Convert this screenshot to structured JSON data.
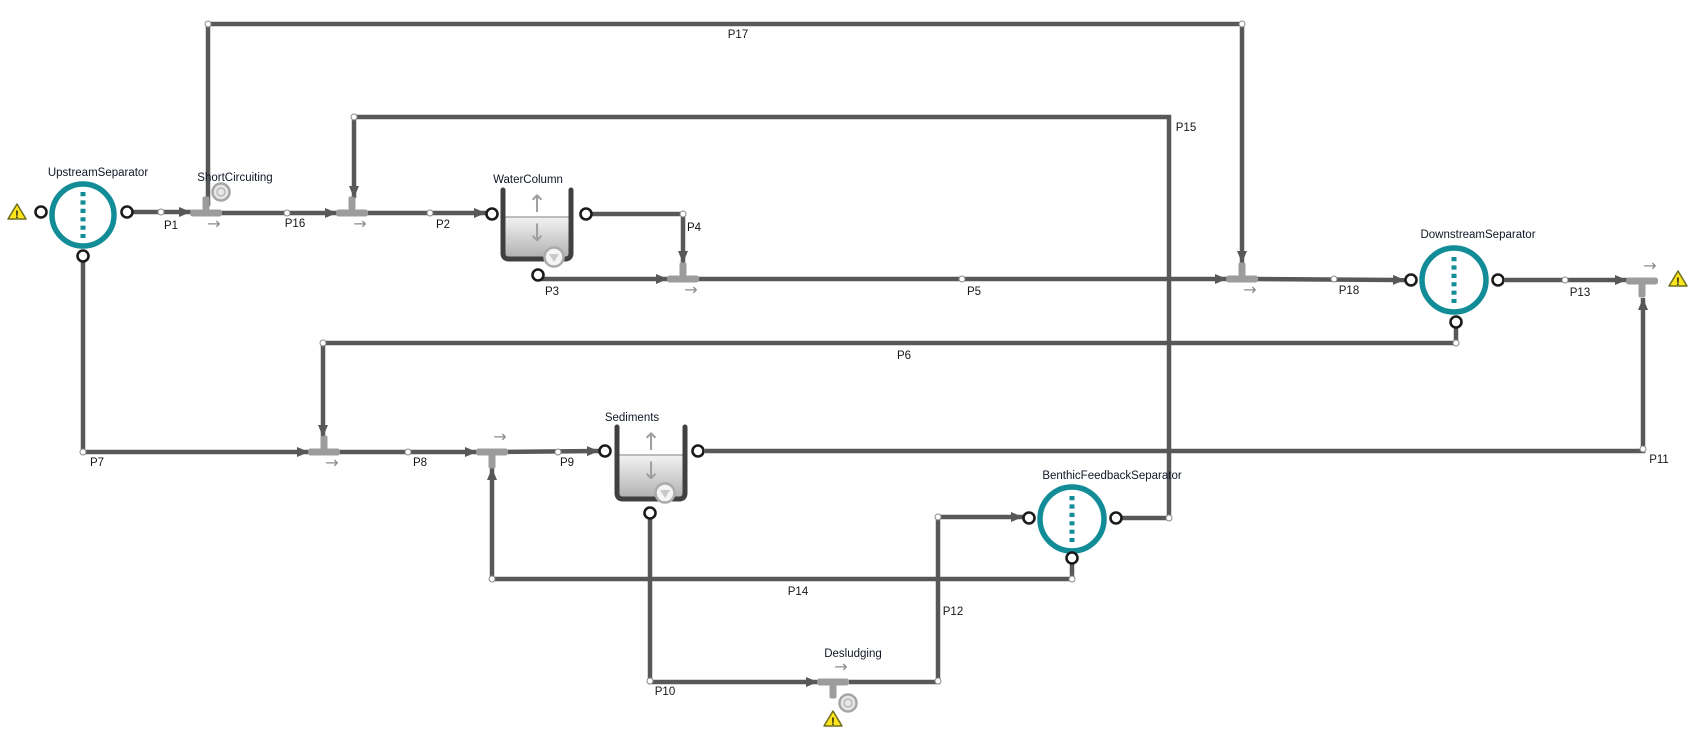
{
  "canvas": {
    "width": 1700,
    "height": 729,
    "background": "#ffffff"
  },
  "colors": {
    "pipe": "#585858",
    "tee": "#9c9c9c",
    "direction_arrow": "#8c8c8c",
    "separator_teal": "#128d98",
    "tank_wall": "#404040",
    "tank_fill_top": "#f3f3f3",
    "tank_fill_bottom": "#b2b2b2",
    "water_line": "#a8a8a8",
    "tank_arrow": "#9e9e9e",
    "port_ring": "#1b1b1b",
    "dot_ring": "#8a8a8a",
    "element_label": "#101826",
    "pipe_label": "#161616",
    "warning_fill": "#ffe51c",
    "warning_border": "#6e6e1e",
    "icon_ring": "#a5a5a5",
    "icon_fill": "#e3e3e3"
  },
  "separators": [
    {
      "id": "upstream-separator",
      "label": "UpstreamSeparator",
      "cx": 83,
      "cy": 215,
      "r": 31,
      "label_cx": 98,
      "label_cy": 172,
      "ports": [
        {
          "x": 41,
          "y": 212
        },
        {
          "x": 127,
          "y": 212
        },
        {
          "x": 83,
          "y": 256
        }
      ]
    },
    {
      "id": "downstream-separator",
      "label": "DownstreamSeparator",
      "cx": 1454,
      "cy": 280,
      "r": 32,
      "label_cx": 1478,
      "label_cy": 234,
      "ports": [
        {
          "x": 1411,
          "y": 280
        },
        {
          "x": 1498,
          "y": 280
        },
        {
          "x": 1456,
          "y": 322
        }
      ]
    },
    {
      "id": "benthic-feedback-separator",
      "label": "BenthicFeedbackSeparator",
      "cx": 1072,
      "cy": 519,
      "r": 32,
      "label_cx": 1112,
      "label_cy": 475,
      "ports": [
        {
          "x": 1029,
          "y": 518
        },
        {
          "x": 1116,
          "y": 518
        },
        {
          "x": 1072,
          "y": 558
        }
      ]
    }
  ],
  "tanks": [
    {
      "id": "water-column",
      "label": "WaterColumn",
      "x1": 503,
      "x2": 571,
      "top": 190,
      "bottom": 259,
      "water_y": 217,
      "label_cx": 528,
      "label_cy": 179,
      "ports": [
        {
          "x": 492,
          "y": 214
        },
        {
          "x": 586,
          "y": 214
        },
        {
          "x": 538,
          "y": 275
        }
      ],
      "icon": {
        "x": 554,
        "y": 257
      }
    },
    {
      "id": "sediments",
      "label": "Sediments",
      "x1": 617,
      "x2": 685,
      "top": 427,
      "bottom": 499,
      "water_y": 455,
      "label_cx": 632,
      "label_cy": 417,
      "ports": [
        {
          "x": 605,
          "y": 451
        },
        {
          "x": 698,
          "y": 451
        },
        {
          "x": 650,
          "y": 513
        }
      ],
      "icon": {
        "x": 665,
        "y": 493
      }
    }
  ],
  "junctions": [
    {
      "id": "short-circuiting",
      "label": "ShortCircuiting",
      "x": 206,
      "y": 213,
      "stub": "up",
      "arrow": "below",
      "icon": {
        "x": 221,
        "y": 192
      },
      "label_cx": 235,
      "label_cy": 177
    },
    {
      "id": "junction-p16-p2",
      "x": 352,
      "y": 213,
      "stub": "up",
      "arrow": "below"
    },
    {
      "id": "junction-p3-p5",
      "x": 683,
      "y": 279,
      "stub": "up",
      "arrow": "below"
    },
    {
      "id": "junction-p5-p18",
      "x": 1242,
      "y": 279,
      "stub": "up",
      "arrow": "below"
    },
    {
      "id": "junction-p13-outlet",
      "x": 1642,
      "y": 281,
      "stub": "down",
      "arrow": "above"
    },
    {
      "id": "junction-p7-p8",
      "x": 324,
      "y": 452,
      "stub": "up",
      "arrow": "below"
    },
    {
      "id": "junction-p8-p9",
      "x": 492,
      "y": 452,
      "stub": "down",
      "arrow": "above"
    },
    {
      "id": "desludging",
      "label": "Desludging",
      "x": 833,
      "y": 682,
      "stub": "down",
      "arrow": "above",
      "icon": {
        "x": 848,
        "y": 703
      },
      "label_cx": 853,
      "label_cy": 653
    }
  ],
  "warnings": [
    {
      "id": "warning-upstream-separator",
      "x": 17,
      "y": 212
    },
    {
      "id": "warning-outlet",
      "x": 1678,
      "y": 279
    },
    {
      "id": "warning-desludging",
      "x": 833,
      "y": 719
    }
  ],
  "pipes": [
    {
      "id": "P1",
      "label": "P1",
      "points": [
        [
          133,
          212
        ],
        [
          191,
          212
        ]
      ],
      "label_cx": 171,
      "label_cy": 225,
      "dots": [
        [
          161,
          212
        ]
      ]
    },
    {
      "id": "P16",
      "label": "P16",
      "points": [
        [
          215,
          213
        ],
        [
          337,
          213
        ]
      ],
      "label_cx": 295,
      "label_cy": 223,
      "dots": [
        [
          287,
          213
        ]
      ]
    },
    {
      "id": "P2",
      "label": "P2",
      "points": [
        [
          359,
          213
        ],
        [
          486,
          213
        ]
      ],
      "label_cx": 443,
      "label_cy": 224,
      "dots": [
        [
          430,
          213
        ]
      ]
    },
    {
      "id": "P17",
      "label": "P17",
      "points": [
        [
          208,
          206
        ],
        [
          208,
          24
        ],
        [
          1242,
          24
        ],
        [
          1242,
          263
        ]
      ],
      "label_cx": 738,
      "label_cy": 34,
      "dots": [
        [
          208,
          24
        ],
        [
          1242,
          24
        ]
      ]
    },
    {
      "id": "P15",
      "label": "P15",
      "points": [
        [
          1122,
          518
        ],
        [
          1169,
          518
        ],
        [
          1169,
          117
        ],
        [
          354,
          117
        ],
        [
          354,
          198
        ]
      ],
      "label_cx": 1186,
      "label_cy": 127,
      "dots": [
        [
          1169,
          518
        ],
        [
          354,
          117
        ]
      ]
    },
    {
      "id": "P4",
      "label": "P4",
      "points": [
        [
          592,
          214
        ],
        [
          683,
          214
        ],
        [
          683,
          263
        ]
      ],
      "label_cx": 694,
      "label_cy": 227,
      "dots": [
        [
          683,
          214
        ]
      ]
    },
    {
      "id": "P3",
      "label": "P3",
      "points": [
        [
          538,
          277
        ],
        [
          538,
          279
        ],
        [
          668,
          279
        ]
      ],
      "label_cx": 552,
      "label_cy": 291,
      "dots": []
    },
    {
      "id": "P5",
      "label": "P5",
      "points": [
        [
          691,
          279
        ],
        [
          1227,
          279
        ]
      ],
      "label_cx": 974,
      "label_cy": 291,
      "dots": [
        [
          962,
          279
        ]
      ]
    },
    {
      "id": "P18",
      "label": "P18",
      "points": [
        [
          1251,
          279
        ],
        [
          1405,
          280
        ]
      ],
      "label_cx": 1349,
      "label_cy": 290,
      "dots": [
        [
          1334,
          279
        ]
      ]
    },
    {
      "id": "P13",
      "label": "P13",
      "points": [
        [
          1505,
          280
        ],
        [
          1627,
          280
        ]
      ],
      "label_cx": 1580,
      "label_cy": 292,
      "dots": [
        [
          1565,
          280
        ]
      ]
    },
    {
      "id": "P11",
      "label": "P11",
      "points": [
        [
          705,
          451
        ],
        [
          1643,
          451
        ],
        [
          1643,
          298
        ]
      ],
      "label_cx": 1659,
      "label_cy": 459,
      "dots": [
        [
          1643,
          449
        ]
      ]
    },
    {
      "id": "P6",
      "label": "P6",
      "points": [
        [
          1456,
          328
        ],
        [
          1456,
          343
        ],
        [
          323,
          343
        ],
        [
          323,
          437
        ]
      ],
      "label_cx": 904,
      "label_cy": 355,
      "dots": [
        [
          1456,
          343
        ],
        [
          323,
          343
        ]
      ]
    },
    {
      "id": "P7",
      "label": "P7",
      "points": [
        [
          83,
          262
        ],
        [
          83,
          452
        ],
        [
          309,
          452
        ]
      ],
      "label_cx": 97,
      "label_cy": 462,
      "dots": [
        [
          83,
          452
        ]
      ]
    },
    {
      "id": "P8",
      "label": "P8",
      "points": [
        [
          333,
          452
        ],
        [
          477,
          452
        ]
      ],
      "label_cx": 420,
      "label_cy": 462,
      "dots": [
        [
          408,
          452
        ]
      ]
    },
    {
      "id": "P9",
      "label": "P9",
      "points": [
        [
          501,
          452
        ],
        [
          599,
          451
        ]
      ],
      "label_cx": 567,
      "label_cy": 462,
      "dots": [
        [
          558,
          452
        ]
      ]
    },
    {
      "id": "P14",
      "label": "P14",
      "points": [
        [
          1072,
          564
        ],
        [
          1072,
          579
        ],
        [
          492,
          579
        ],
        [
          492,
          468
        ]
      ],
      "label_cx": 798,
      "label_cy": 591,
      "dots": [
        [
          1072,
          579
        ],
        [
          492,
          579
        ]
      ]
    },
    {
      "id": "P10",
      "label": "P10",
      "points": [
        [
          650,
          519
        ],
        [
          650,
          682
        ],
        [
          818,
          682
        ]
      ],
      "label_cx": 665,
      "label_cy": 691,
      "dots": [
        [
          650,
          681
        ]
      ]
    },
    {
      "id": "P12",
      "label": "P12",
      "points": [
        [
          849,
          682
        ],
        [
          938,
          682
        ],
        [
          938,
          517
        ],
        [
          1023,
          517
        ]
      ],
      "label_cx": 953,
      "label_cy": 611,
      "dots": [
        [
          938,
          681
        ],
        [
          938,
          517
        ]
      ]
    }
  ]
}
